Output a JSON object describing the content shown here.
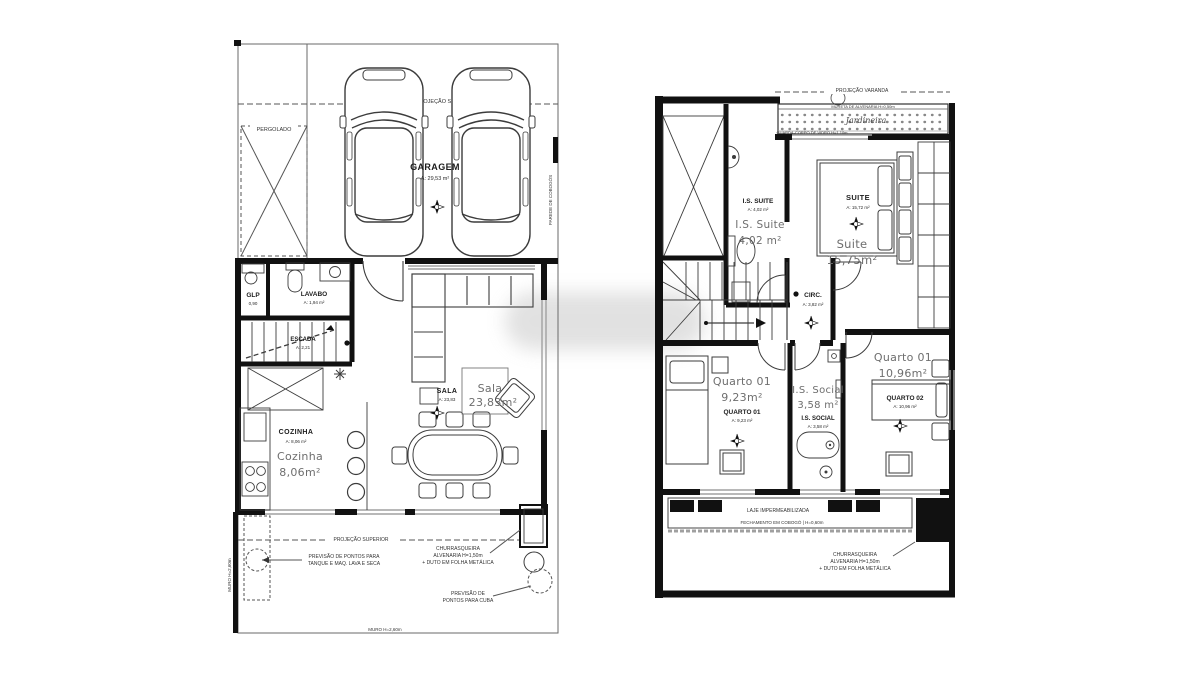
{
  "document": {
    "type": "architectural-floor-plans",
    "sheets": [
      "pavimento térreo",
      "pavimento superior"
    ]
  },
  "colors": {
    "wall": "#111111",
    "line": "#3c3c3c",
    "window": "#a0a0a0",
    "overlay_text": "#6e6e6e",
    "background": "#ffffff"
  },
  "left_plan": {
    "pergolado_label": "PERGOLADO",
    "projecao_superior_top": "PROJEÇÃO SUPERIOR",
    "parede_cobogos": "PAREDE DE COBOGÓS",
    "garagem": {
      "label": "GARAGEM",
      "area": "A: 29,53 m²"
    },
    "glp": {
      "label": "GLP",
      "area": "0,90"
    },
    "lavabo": {
      "label": "LAVABO",
      "area": "A: 1,94 m²"
    },
    "escada": {
      "label": "ESCADA",
      "area": "A: 2,21"
    },
    "sala": {
      "label": "SALA",
      "area": "A: 23,83",
      "overlay_name": "Sala",
      "overlay_area": "23,83m²"
    },
    "cozinha": {
      "label": "COZINHA",
      "area": "A: 8,06 m²",
      "overlay_name": "Cozinha",
      "overlay_area": "8,06m²"
    },
    "projecao_superior_quintal": "PROJEÇÃO SUPERIOR",
    "nota_tanque_1": "PREVISÃO DE PONTOS PARA",
    "nota_tanque_2": "TANQUE E MAQ. LAVA E SECA",
    "nota_churrasqueira_1": "CHURRASQUEIRA",
    "nota_churrasqueira_2": "ALVENARIA H=1,50m",
    "nota_churrasqueira_3": "+ DUTO EM FOLHA METÁLICA",
    "nota_cuba_1": "PREVISÃO DE",
    "nota_cuba_2": "PONTOS PARA CUBA",
    "muro_inferior": "MURO H=2,60m",
    "muro_lateral": "MURO H=2,60m"
  },
  "right_plan": {
    "projecao_varanda": "PROJEÇÃO VARANDA",
    "jardineira": {
      "mureta": "MURETA DE ALVENARIA H=0,50m",
      "script": "Jardineira",
      "vidro": "GUARDA-CORPO DE VIDRO H=1,10m"
    },
    "is_suite": {
      "label": "I.S. SUITE",
      "area": "A: 4,02 m²",
      "overlay_name": "I.S. Suite",
      "overlay_area": "4,02 m²"
    },
    "suite": {
      "label": "SUITE",
      "area": "A: 15,72 m²",
      "overlay_name": "Suite",
      "overlay_area": "15,75m²"
    },
    "circ": {
      "label": "CIRC.",
      "area": "A: 3,82 m²"
    },
    "quarto01": {
      "label": "QUARTO 01",
      "area": "A: 9,23 m²",
      "overlay_name": "Quarto 01",
      "overlay_area": "9,23m²"
    },
    "is_social": {
      "label": "I.S. SOCIAL",
      "area": "A: 3,58 m²",
      "overlay_name": "I.S. Social",
      "overlay_area": "3,58 m²"
    },
    "quarto02": {
      "label": "QUARTO 02",
      "area": "A: 10,96 m²",
      "overlay_name": "Quarto 01",
      "overlay_area": "10,96m²"
    },
    "laje": "LAJE IMPERMEABILIZADA",
    "fechamento": "FECHAMENTO EM COBOGÓ | H=0,60m",
    "nota_churrasqueira_1": "CHURRASQUEIRA",
    "nota_churrasqueira_2": "ALVENARIA H=1,50m",
    "nota_churrasqueira_3": "+ DUTO EM FOLHA METÁLICA"
  }
}
